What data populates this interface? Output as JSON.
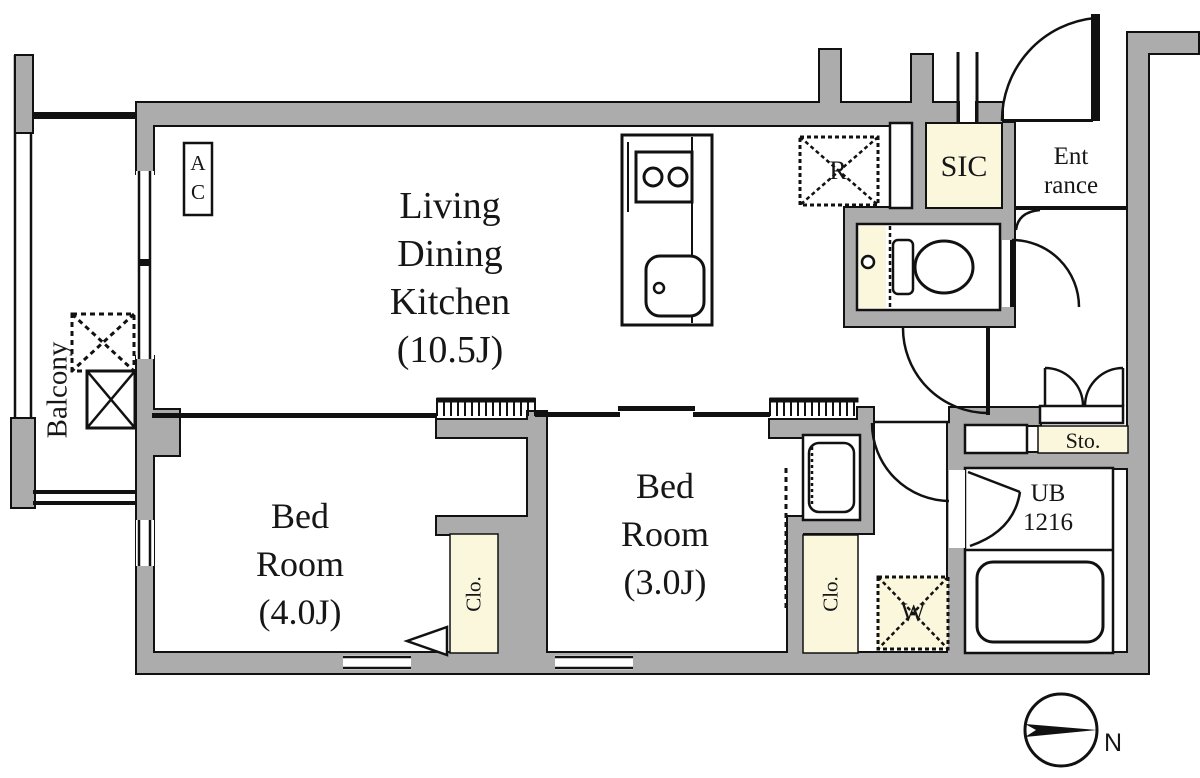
{
  "rooms": {
    "ldk": {
      "lines": [
        "Living",
        "Dining",
        "Kitchen",
        "(10.5J)"
      ]
    },
    "bedroom1": {
      "lines": [
        "Bed",
        "Room",
        "(4.0J)"
      ]
    },
    "bedroom2": {
      "lines": [
        "Bed",
        "Room",
        "(3.0J)"
      ]
    },
    "balcony": {
      "label": "Balcony"
    },
    "entrance": {
      "lines": [
        "Ent",
        "rance"
      ]
    },
    "sic": {
      "label": "SIC"
    },
    "storage": {
      "label": "Sto."
    },
    "unit_bath": {
      "lines": [
        "UB",
        "1216"
      ]
    },
    "closet_bedroom1": {
      "label": "Clo."
    },
    "closet_bedroom2": {
      "label": "Clo."
    }
  },
  "fixtures": {
    "refrigerator": {
      "label": "R"
    },
    "washer": {
      "label": "W"
    },
    "air_conditioner": {
      "lines": [
        "A",
        "C"
      ]
    }
  },
  "compass": {
    "label": "N"
  },
  "colors": {
    "wall_gray": "#ACACAC",
    "cream": "#FAF7DC",
    "line": "#111111",
    "background": "#FFFFFF"
  }
}
